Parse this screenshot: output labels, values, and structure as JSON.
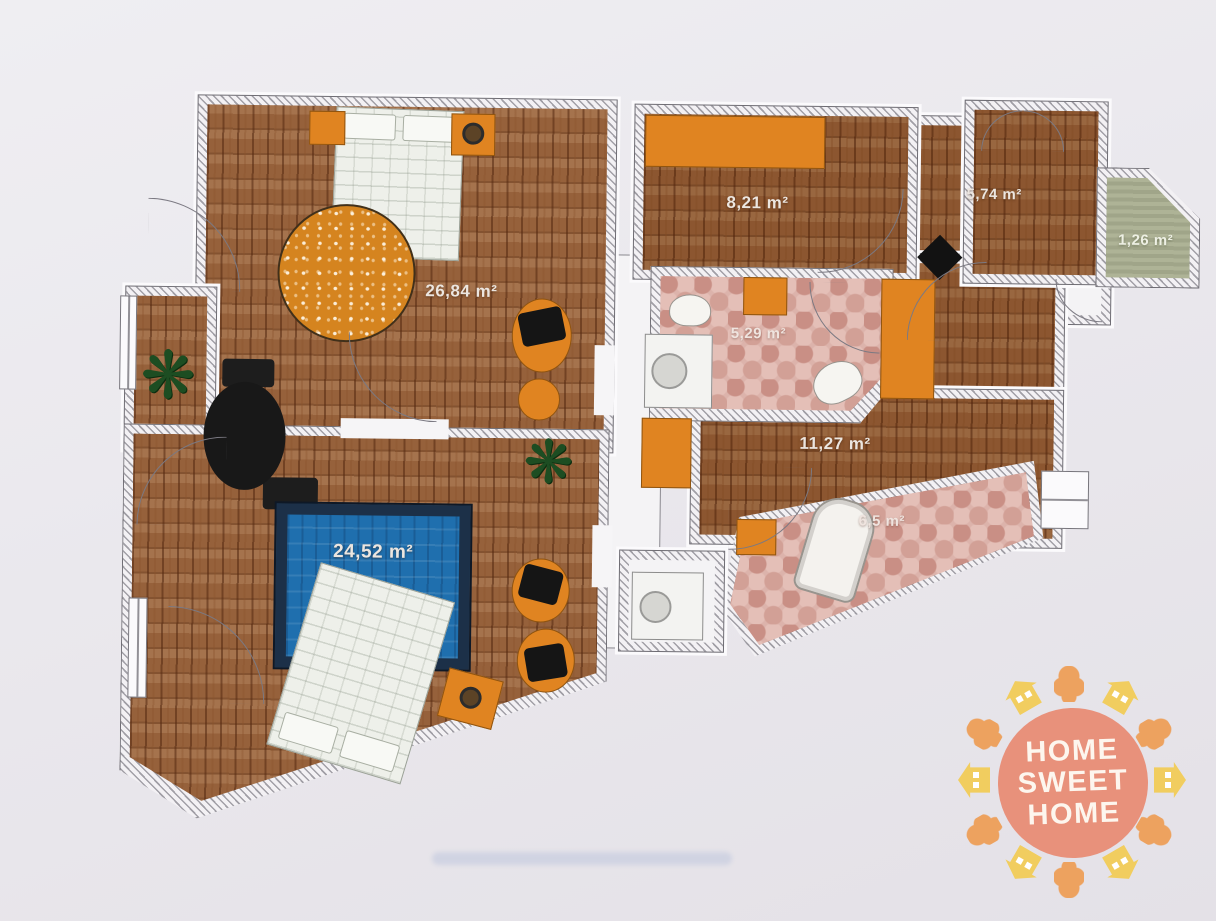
{
  "plan": {
    "rooms": [
      {
        "id": "living-room",
        "label": "26,84 m²"
      },
      {
        "id": "bedroom",
        "label": "24,52 m²"
      },
      {
        "id": "room-small-a",
        "label": "8,21 m²"
      },
      {
        "id": "room-small-b",
        "label": "5,74 m²"
      },
      {
        "id": "balcony",
        "label": "1,26 m²"
      },
      {
        "id": "bathroom",
        "label": "5,29 m²"
      },
      {
        "id": "hallway",
        "label": "11,27 m²"
      },
      {
        "id": "wc",
        "label": "6,5 m²"
      }
    ],
    "colors": {
      "wood": "#96613b",
      "tile_pink": "#dcb3ab",
      "balcony_green": "#a9ae90",
      "accent_orange": "#e08421",
      "rug_blue": "#1f6fae",
      "wall_hatch": "#f3f1f4"
    }
  },
  "logo": {
    "line1": "HOME",
    "line2": "SWEET",
    "line3": "HOME",
    "colors": {
      "badge": "#e8917b",
      "house_yellow": "#f1cd5f",
      "tree_orange": "#eda25f"
    }
  }
}
